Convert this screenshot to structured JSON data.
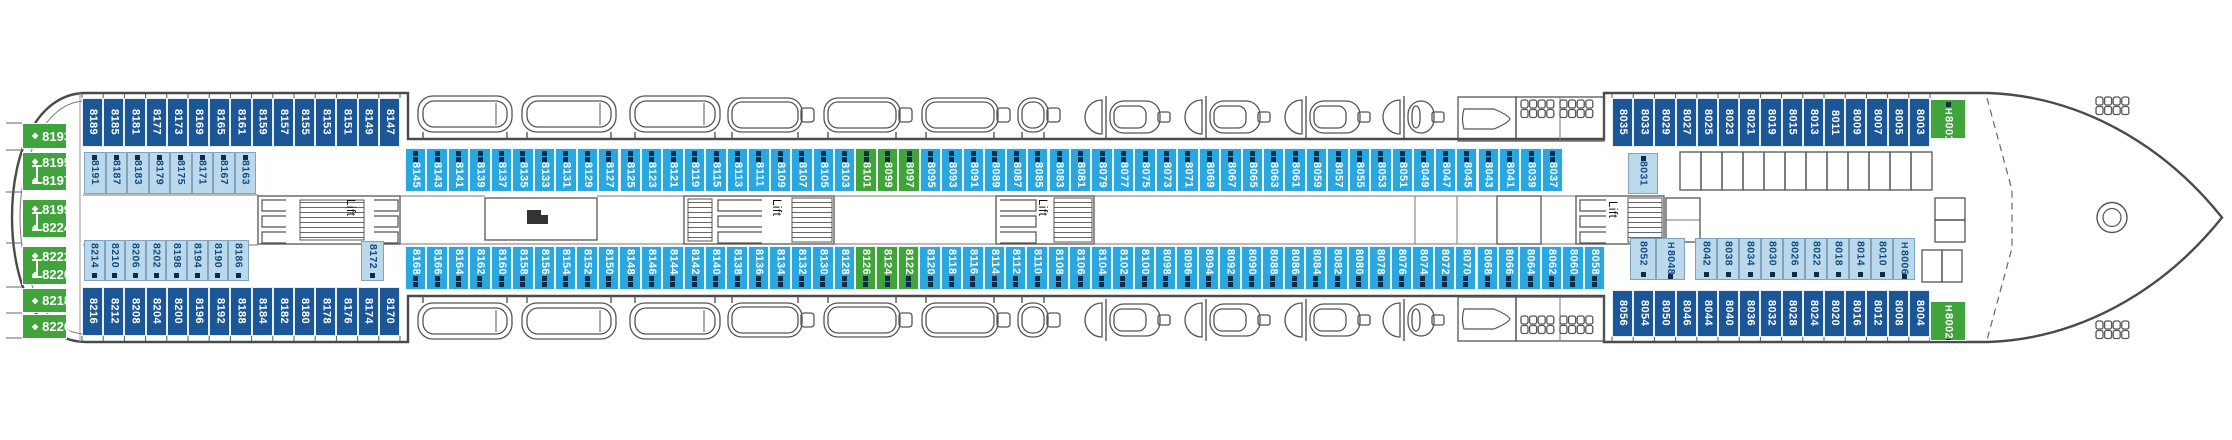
{
  "labels": {
    "lift": "Lift",
    "handicap": "H"
  },
  "markers": {
    "diamond": "◆"
  },
  "colors": {
    "dark_cabin": "#1B5796",
    "cyan_cabin": "#2BA7E0",
    "light_cabin": "#BCD9EC",
    "green_cabin": "#41A33C",
    "obstruction_marker": "#0E2B49",
    "light_cabin_text": "#124B80"
  },
  "cabin_rows": {
    "aft_top_outer": [
      "8189",
      "8185",
      "8181",
      "8177",
      "8173",
      "8169",
      "8165",
      "8161",
      "8159",
      "8157",
      "8155",
      "8153",
      "8151",
      "8149",
      "8147"
    ],
    "aft_top_inner": [
      "8191",
      "8187",
      "8183",
      "8179",
      "8175",
      "8171",
      "8167",
      "8163"
    ],
    "mid_top": [
      "8145",
      "8143",
      "8141",
      "8139",
      "8137",
      "8135",
      "8133",
      "8131",
      "8129",
      "8127",
      "8125",
      "8123",
      "8121",
      "8119",
      "8115",
      "8113",
      "8111",
      "8109",
      "8107",
      "8105",
      "8103",
      {
        "num": "8101",
        "green": true
      },
      {
        "num": "8099",
        "green": true
      },
      {
        "num": "8097",
        "green": true
      },
      "8095",
      "8093",
      "8091",
      "8089",
      "8087",
      "8085",
      "8083",
      "8081",
      "8079",
      "8077",
      "8075",
      "8073",
      "8071",
      "8069",
      "8067",
      "8065",
      "8063",
      "8061",
      "8059",
      "8057",
      "8055",
      "8053",
      "8051",
      "8049",
      "8047",
      "8045",
      "8043",
      "8041",
      "8039",
      "8037"
    ],
    "aft_bottom_inner": [
      "8214",
      "8210",
      "8206",
      "8202",
      "8198",
      "8194",
      "8190",
      "8186"
    ],
    "mid_bottom": [
      "8168",
      "8166",
      "8164",
      "8162",
      "8160",
      "8158",
      "8156",
      "8154",
      "8152",
      "8150",
      "8148",
      "8146",
      "8144",
      "8142",
      "8140",
      "8138",
      "8136",
      "8134",
      "8132",
      "8130",
      "8128",
      {
        "num": "8126",
        "green": true
      },
      {
        "num": "8124",
        "green": true
      },
      {
        "num": "8122",
        "green": true
      },
      "8120",
      "8118",
      "8116",
      "8114",
      "8112",
      "8110",
      "8108",
      "8106",
      "8104",
      "8102",
      "8100",
      "8098",
      "8096",
      "8094",
      "8092",
      "8090",
      "8088",
      "8086",
      "8084",
      "8082",
      "8080",
      "8078",
      "8076",
      "8074",
      "8072",
      "8070",
      "8068",
      "8066",
      "8064",
      "8062",
      "8060",
      "8058"
    ],
    "aft_bottom_outer": [
      "8216",
      "8212",
      "8208",
      "8204",
      "8200",
      "8196",
      "8192",
      "8188",
      "8184",
      "8182",
      "8180",
      "8178",
      "8176",
      "8174",
      "8170"
    ],
    "fwd_top_outer": [
      "8035",
      "8033",
      "8029",
      "8027",
      "8025",
      "8023",
      "8021",
      "8019",
      "8015",
      "8013",
      "8011",
      "8009",
      "8007",
      "8005",
      "8003"
    ],
    "fwd_bottom_inner_run": [
      "8042",
      "8038",
      "8034",
      "8030",
      "8026",
      "8022",
      "8018",
      "8014",
      "8010",
      {
        "num": "8006",
        "h": true
      }
    ],
    "fwd_bottom_outer": [
      "8056",
      "8054",
      "8050",
      "8046",
      "8044",
      "8040",
      "8036",
      "8032",
      "8028",
      "8024",
      "8020",
      "8016",
      "8012",
      "8008",
      "8004"
    ]
  },
  "single_cabins": {
    "c8031": {
      "num": "8031"
    },
    "c8172": {
      "num": "8172"
    },
    "c8052": {
      "num": "8052"
    },
    "c8048": {
      "num": "8048",
      "h": true
    },
    "c8001": {
      "num": "8001",
      "h": true
    },
    "c8002": {
      "num": "8002",
      "h": true
    }
  },
  "stern_suites": [
    {
      "num": "8193"
    },
    {
      "num": "8195"
    },
    {
      "num": "8197"
    },
    {
      "num": "8199"
    },
    {
      "num": "8224"
    },
    {
      "num": "8222"
    },
    {
      "num": "8220"
    },
    {
      "num": "8218"
    },
    {
      "num": "8226"
    }
  ]
}
